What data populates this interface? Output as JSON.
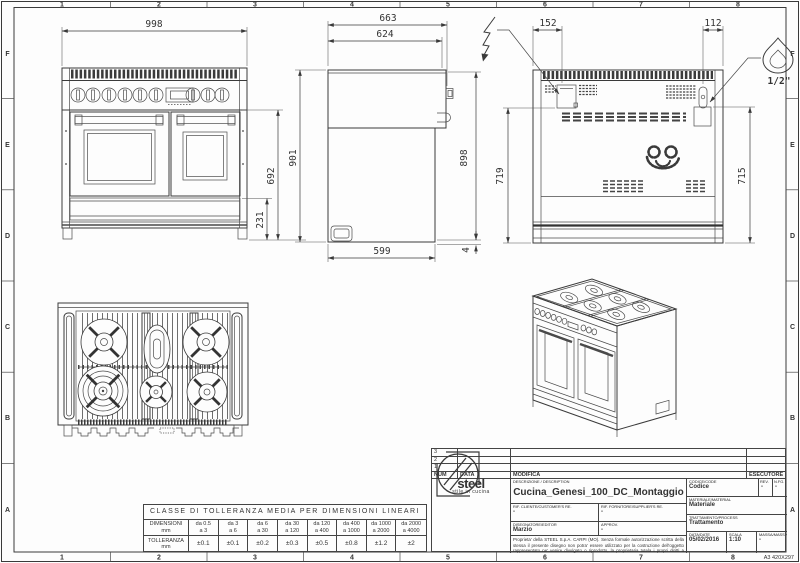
{
  "frame": {
    "cols": [
      "1",
      "2",
      "3",
      "4",
      "5",
      "6",
      "7",
      "8"
    ],
    "rows": [
      "F",
      "E",
      "D",
      "C",
      "B",
      "A"
    ],
    "sheet_format": "A3 420X297"
  },
  "dims": {
    "front_width": "998",
    "front_door_height": "692",
    "front_drawer_height": "231",
    "height_left": "901",
    "side_depth_total": "663",
    "side_depth_top": "624",
    "side_height_right": "898",
    "side_depth_bottom": "599",
    "side_floor_gap": "4",
    "rear_electric_offset": "152",
    "rear_gas_offset": "112",
    "rear_electric_height": "719",
    "rear_gas_height": "715",
    "gas_thread": "1/2\""
  },
  "icons": {
    "electric": "lightning-icon",
    "gas": "flame-icon"
  },
  "tolerance_table": {
    "title": "CLASSE DI TOLLERANZA MEDIA PER DIMENSIONI LINEARI",
    "dim_label": "DIMENSIONI",
    "tol_label": "TOLLERANZA",
    "unit": "mm",
    "ranges": [
      {
        "from": "da 0.5",
        "to": "a 3"
      },
      {
        "from": "da 3",
        "to": "a 6"
      },
      {
        "from": "da 6",
        "to": "a 30"
      },
      {
        "from": "da 30",
        "to": "a 120"
      },
      {
        "from": "da 120",
        "to": "a 400"
      },
      {
        "from": "da 400",
        "to": "a 1000"
      },
      {
        "from": "da 1000",
        "to": "a 2000"
      },
      {
        "from": "da 2000",
        "to": "a 4000"
      }
    ],
    "tolerances": [
      "±0.1",
      "±0.1",
      "±0.2",
      "±0.3",
      "±0.5",
      "±0.8",
      "±1.2",
      "±2"
    ]
  },
  "title_block": {
    "revision_rows": [
      "3",
      "2",
      "1"
    ],
    "num_header": "NUM",
    "data_header": "DATA",
    "modifica_header": "MODIFICA",
    "esecutore_header": "ESECUTORE",
    "logo_text": "steel",
    "logo_tagline": "stile in cucina",
    "description_label": "DESCRIZIONE / DESCRIPTION",
    "description": "Cucina_Genesi_100_DC_Montaggio",
    "codice_label": "CODICE/CODE",
    "codice": "Codice",
    "rev_label": "REV.",
    "rev": "-",
    "nfg_label": "N.FG.",
    "nfg": "-",
    "materiale_label": "MATERIALE/MATERIAL",
    "materiale": "Materiale",
    "rif_cliente_label": "RIF. CLIENTE/CUSTOMER'S RE.",
    "rif_cliente": "-",
    "rif_fornitore_label": "RIF. FORNITORE/SUPPLIER'S RE.",
    "rif_fornitore": "-",
    "trattamento_label": "TRATTAMENTO/PROCESS",
    "trattamento": "Trattamento",
    "disegnatore_label": "DISEGNATORE/EDITOR",
    "disegnatore": "Marzio",
    "approv_label": "APPROV.",
    "approv": "-",
    "data_label": "DATA/DATE",
    "data_value": "05/02/2016",
    "scala_label": "SCALA",
    "scala": "1:10",
    "massa_label": "MASSA/MASS Kg",
    "massa": "-",
    "legal": "Proprieta' della STEEL S.p.A. CARPI (MO). Senza formale autorizzazione scritta della stessa il presente disegno non potra' essere utilizzato per la costruzione dell'oggetto rappresentato ne' venire divulgato o riprodotto, la proprietaria tutela i propri diritti a rigore di legge."
  }
}
